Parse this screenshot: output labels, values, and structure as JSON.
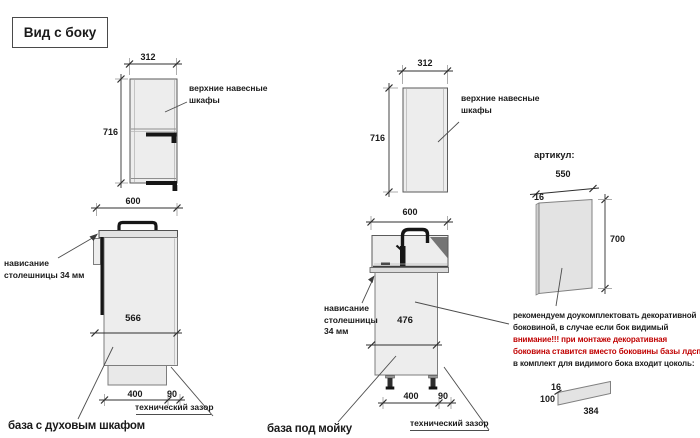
{
  "title": "Вид с боку",
  "colors": {
    "accent_red": "#c00000",
    "line": "#2f2f2f",
    "cabinet_fill": "#ededed"
  },
  "left": {
    "caption": "база с духовым шкафом",
    "upper": {
      "width": "312",
      "height": "716",
      "label": "верхние навесные\nшкафы"
    },
    "lower": {
      "width": "600",
      "depth": "566",
      "plinth_width": "400",
      "gap": "90",
      "overhang_label": "нависание\nстолешницы 34 мм",
      "gap_label": "технический зазор"
    }
  },
  "middle": {
    "caption": "база под мойку",
    "upper": {
      "width": "312",
      "height": "716",
      "label": "верхние навесные\nшкафы"
    },
    "lower": {
      "width": "600",
      "depth": "476",
      "plinth_width": "400",
      "gap": "90",
      "overhang_label": "нависание\nстолешницы\n34 мм",
      "gap_label": "технический зазор"
    }
  },
  "right": {
    "heading": "артикул:",
    "panel": {
      "width": "550",
      "thickness": "16",
      "height": "700"
    },
    "note_lines": [
      "рекомендуем доукомплектовать декоративной",
      "боковиной, в случае если бок видимый",
      "внимание!!! при монтаже декоративная",
      "боковина ставится вместо боковины базы лдсп",
      "в комплект для видимого бока входит цоколь:"
    ],
    "plinth": {
      "thickness": "16",
      "height": "100",
      "length": "384"
    }
  }
}
